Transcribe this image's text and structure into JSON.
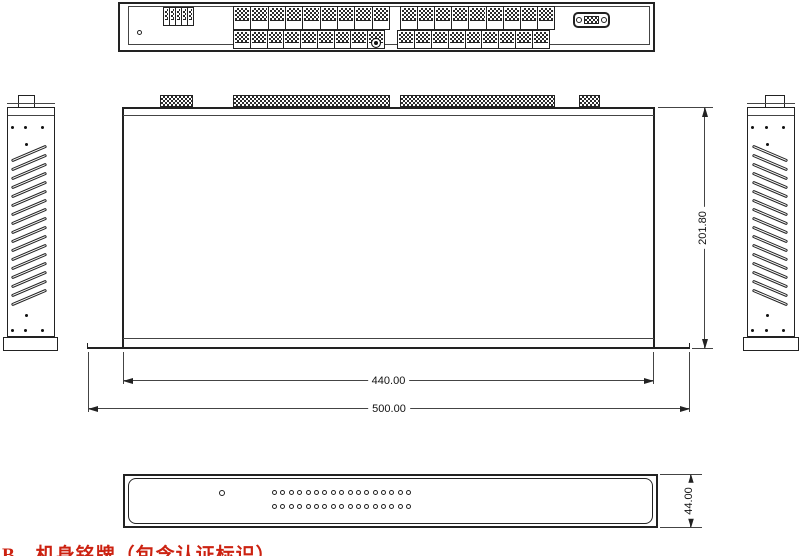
{
  "drawing": {
    "dim_body_width": "440.00",
    "dim_total_width": "500.00",
    "dim_height": "201.80",
    "dim_depth": "44.00"
  },
  "caption": "B、机身铭牌（包含认证标识）",
  "colors": {
    "line": "#222222",
    "thin": "#444444",
    "caption": "#cc2211"
  },
  "counts": {
    "vent_slats": 17,
    "front_holes_per_row": 17,
    "terminal_cells_per_group": 9,
    "power_block_cells": 5
  }
}
